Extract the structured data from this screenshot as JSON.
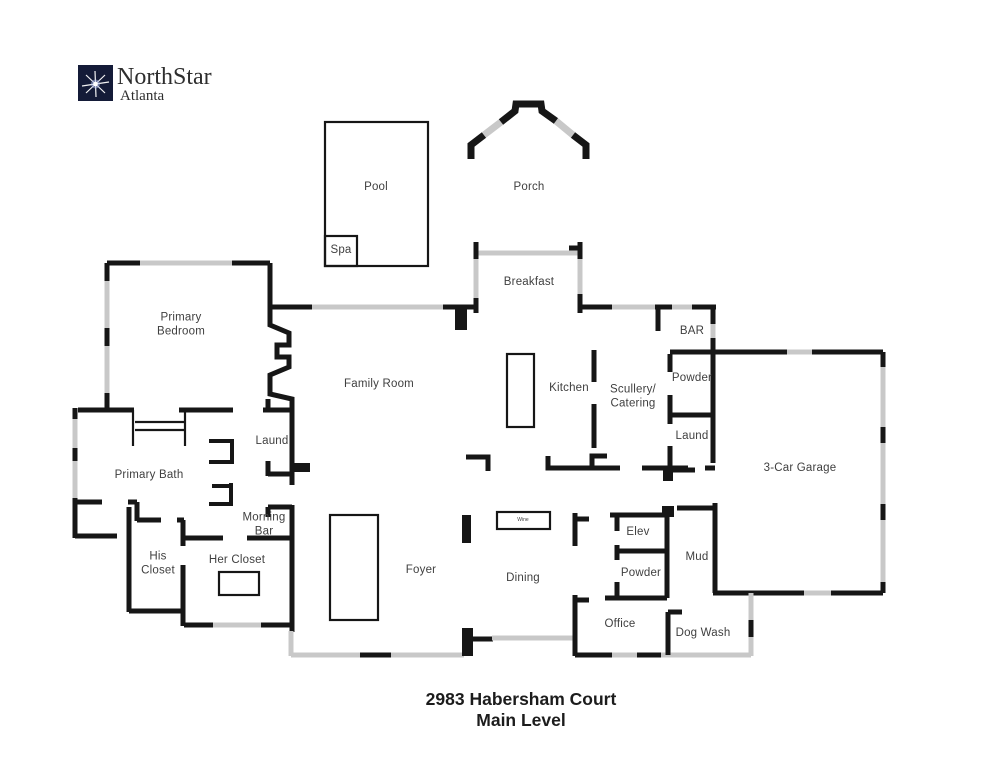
{
  "logo": {
    "name": "NorthStar",
    "city": "Atlanta",
    "mark_color": "#141b38",
    "star_color": "#ffffff"
  },
  "title": {
    "line1": "2983 Habersham Court",
    "line2": "Main Level"
  },
  "colors": {
    "wall": "#161616",
    "window": "#c8c8c8",
    "background": "#ffffff",
    "label_text": "#3f3f3f",
    "title_text": "#1c1c1c"
  },
  "rooms": [
    {
      "id": "pool",
      "label": "Pool",
      "x": 376,
      "y": 188
    },
    {
      "id": "spa",
      "label": "Spa",
      "x": 341,
      "y": 251
    },
    {
      "id": "porch",
      "label": "Porch",
      "x": 529,
      "y": 188
    },
    {
      "id": "breakfast",
      "label": "Breakfast",
      "x": 529,
      "y": 283
    },
    {
      "id": "primary-bedroom",
      "label": "Primary\nBedroom",
      "x": 181,
      "y": 325
    },
    {
      "id": "family-room",
      "label": "Family Room",
      "x": 379,
      "y": 385
    },
    {
      "id": "kitchen",
      "label": "Kitchen",
      "x": 569,
      "y": 389
    },
    {
      "id": "scullery-catering",
      "label": "Scullery/\nCatering",
      "x": 633,
      "y": 397
    },
    {
      "id": "bar",
      "label": "BAR",
      "x": 692,
      "y": 332
    },
    {
      "id": "powder-upper",
      "label": "Powder",
      "x": 692,
      "y": 379
    },
    {
      "id": "laundry-right",
      "label": "Laund",
      "x": 692,
      "y": 437
    },
    {
      "id": "garage",
      "label": "3-Car Garage",
      "x": 800,
      "y": 469
    },
    {
      "id": "primary-bath",
      "label": "Primary Bath",
      "x": 149,
      "y": 476
    },
    {
      "id": "laundry-left",
      "label": "Laund",
      "x": 272,
      "y": 442
    },
    {
      "id": "morning-bar",
      "label": "Morning\nBar",
      "x": 264,
      "y": 525
    },
    {
      "id": "his-closet",
      "label": "His\nCloset",
      "x": 158,
      "y": 564
    },
    {
      "id": "her-closet",
      "label": "Her Closet",
      "x": 237,
      "y": 561
    },
    {
      "id": "foyer",
      "label": "Foyer",
      "x": 421,
      "y": 571
    },
    {
      "id": "dining",
      "label": "Dining",
      "x": 523,
      "y": 579
    },
    {
      "id": "wine-cabinet",
      "label": "Wine",
      "x": 523,
      "y": 521,
      "size": "tiny"
    },
    {
      "id": "elev",
      "label": "Elev",
      "x": 638,
      "y": 533
    },
    {
      "id": "powder-lower",
      "label": "Powder",
      "x": 641,
      "y": 574
    },
    {
      "id": "mud",
      "label": "Mud",
      "x": 697,
      "y": 558
    },
    {
      "id": "office",
      "label": "Office",
      "x": 620,
      "y": 625
    },
    {
      "id": "dog-wash",
      "label": "Dog Wash",
      "x": 703,
      "y": 634
    }
  ]
}
